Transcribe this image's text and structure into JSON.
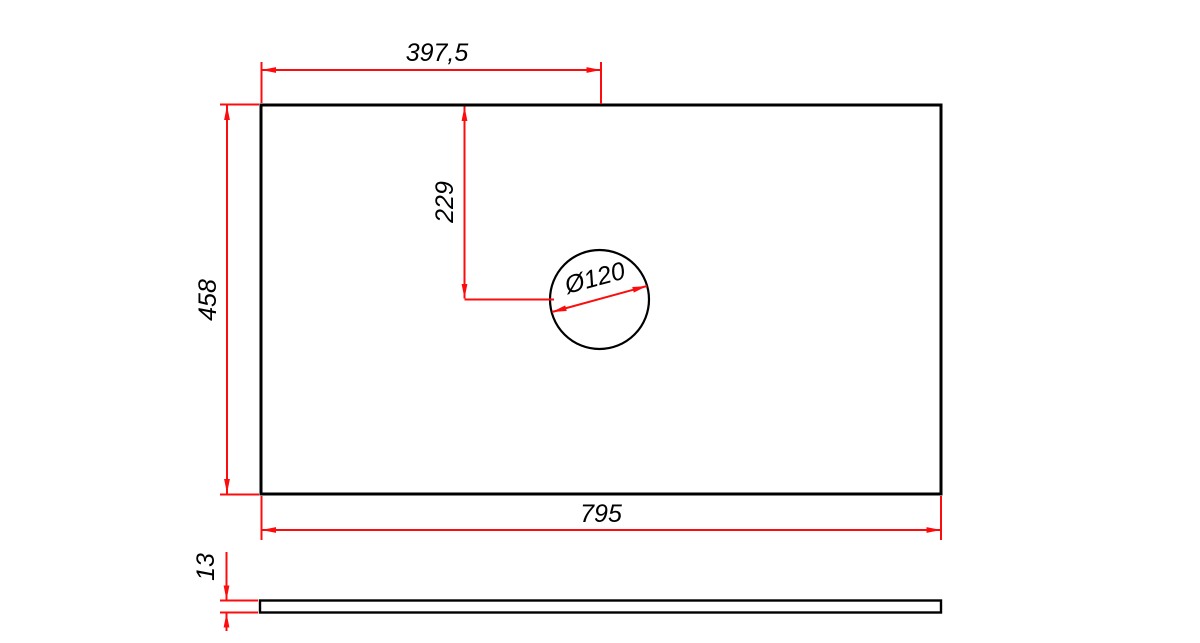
{
  "colors": {
    "dimension_red": "#fb0d0d",
    "outline_black": "#000000",
    "background": "#ffffff"
  },
  "views": {
    "front": {
      "dim_top_width": "397,5",
      "dim_left_height": "458",
      "dim_hole_center_from_top": "229",
      "dim_hole_diameter": "Ø120",
      "dim_bottom_width": "795"
    },
    "side": {
      "dim_thickness": "13"
    }
  }
}
